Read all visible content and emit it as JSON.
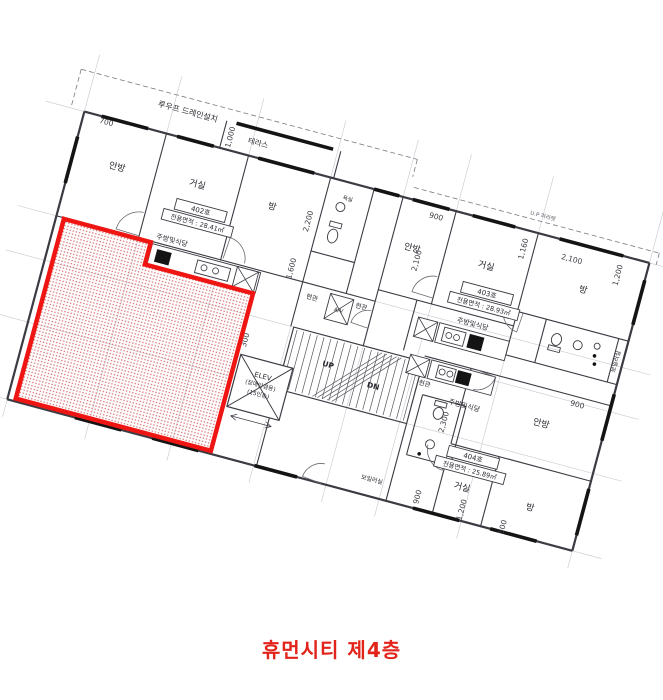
{
  "caption": "휴먼시티 제4층",
  "colors": {
    "caption": "#e2231a",
    "red_outline": "#ee1512",
    "red_dot": "#df7f7f",
    "wall": "#3b3b43",
    "guide": "#c7c7cf",
    "dash": "#7a7a82",
    "text": "#26262e",
    "dim": "#3a3a42",
    "black_fixture": "#141414"
  },
  "plan": {
    "pivot": [
      88,
      98
    ],
    "rotation": 15,
    "guides": [
      [
        0,
        -45,
        0,
        330
      ],
      [
        85,
        -45,
        85,
        330
      ],
      [
        170,
        -45,
        170,
        330
      ],
      [
        255,
        -45,
        255,
        330
      ],
      [
        330,
        -45,
        330,
        330
      ],
      [
        385,
        -45,
        385,
        330
      ],
      [
        470,
        -45,
        470,
        330
      ],
      [
        585,
        -45,
        585,
        330
      ],
      [
        -40,
        14,
        615,
        14
      ],
      [
        -40,
        122,
        615,
        122
      ],
      [
        -40,
        168,
        615,
        168
      ],
      [
        -40,
        232,
        615,
        232
      ],
      [
        -40,
        312,
        615,
        312
      ]
    ],
    "dashed": [
      [
        -14,
        -26,
        334,
        -26
      ],
      [
        -14,
        -26,
        -14,
        12
      ],
      [
        334,
        -26,
        334,
        -8
      ],
      [
        338,
        2,
        592,
        2
      ],
      [
        592,
        2,
        592,
        14
      ]
    ],
    "outer": [
      [
        0,
        14,
        585,
        14
      ],
      [
        585,
        14,
        585,
        312
      ],
      [
        585,
        312,
        0,
        312
      ],
      [
        0,
        312,
        0,
        14
      ]
    ],
    "walls": [
      [
        140,
        -14,
        140,
        14
      ],
      [
        258,
        -14,
        258,
        14
      ],
      [
        85,
        14,
        85,
        122
      ],
      [
        170,
        14,
        170,
        122
      ],
      [
        0,
        122,
        255,
        122
      ],
      [
        255,
        14,
        255,
        168
      ],
      [
        300,
        14,
        300,
        122
      ],
      [
        255,
        90,
        300,
        90
      ],
      [
        255,
        122,
        330,
        122
      ],
      [
        330,
        14,
        330,
        168
      ],
      [
        385,
        14,
        385,
        110
      ],
      [
        330,
        110,
        470,
        110
      ],
      [
        470,
        14,
        470,
        140
      ],
      [
        470,
        95,
        585,
        95
      ],
      [
        500,
        95,
        500,
        140
      ],
      [
        470,
        140,
        585,
        140
      ],
      [
        575,
        95,
        575,
        140
      ],
      [
        370,
        110,
        370,
        162
      ],
      [
        392,
        162,
        585,
        162
      ],
      [
        440,
        162,
        440,
        240
      ],
      [
        440,
        240,
        585,
        240
      ],
      [
        490,
        240,
        490,
        312
      ],
      [
        400,
        200,
        445,
        200
      ],
      [
        445,
        200,
        445,
        262
      ],
      [
        400,
        262,
        445,
        262
      ],
      [
        400,
        200,
        400,
        262
      ],
      [
        440,
        262,
        440,
        312
      ],
      [
        258,
        232,
        258,
        312
      ],
      [
        392,
        232,
        392,
        312
      ]
    ],
    "windows": [
      [
        18,
        14,
        66,
        14
      ],
      [
        96,
        14,
        134,
        14
      ],
      [
        180,
        14,
        238,
        14
      ],
      [
        300,
        14,
        326,
        14
      ],
      [
        340,
        14,
        378,
        14
      ],
      [
        402,
        14,
        446,
        14
      ],
      [
        492,
        14,
        558,
        14
      ],
      [
        585,
        32,
        585,
        78
      ],
      [
        585,
        150,
        585,
        198
      ],
      [
        585,
        248,
        585,
        296
      ],
      [
        70,
        312,
        118,
        312
      ],
      [
        150,
        312,
        198,
        312
      ],
      [
        256,
        312,
        300,
        312
      ],
      [
        420,
        312,
        468,
        312
      ],
      [
        500,
        312,
        548,
        312
      ],
      [
        0,
        40,
        0,
        88
      ],
      [
        150,
        -14,
        250,
        -14
      ]
    ],
    "thin": [
      [
        220,
        270,
        262,
        270
      ],
      [
        220,
        270,
        226,
        267
      ],
      [
        220,
        270,
        226,
        273
      ],
      [
        262,
        270,
        256,
        267
      ],
      [
        262,
        270,
        256,
        273
      ]
    ],
    "stairs": {
      "box": [
        258,
        168,
        134,
        64
      ],
      "tread_x1": 262,
      "tread_x2": 388,
      "tread_y1": 170,
      "tread_y2": 230,
      "step": 7,
      "diag": [
        [
          294,
          230,
          350,
          170
        ],
        [
          299,
          230,
          355,
          170
        ],
        [
          304,
          230,
          360,
          170
        ],
        [
          309,
          230,
          365,
          170
        ],
        [
          314,
          230,
          370,
          170
        ]
      ]
    },
    "elevator": {
      "box": [
        214,
        208,
        54,
        54
      ],
      "lines": [
        "ELEV",
        "(장애인겸용)",
        "(15인승)"
      ],
      "cx": 241,
      "ty": 226,
      "lh": 9
    },
    "rects": [
      [
        285,
        126,
        24,
        26
      ],
      [
        100,
        124,
        112,
        21
      ],
      [
        398,
        126,
        72,
        20
      ],
      [
        400,
        164,
        66,
        19
      ],
      [
        188,
        124,
        22,
        21
      ],
      [
        376,
        126,
        20,
        20
      ],
      [
        378,
        164,
        20,
        19
      ],
      [
        148,
        128,
        34,
        13
      ],
      [
        404,
        129,
        22,
        14
      ],
      [
        408,
        167,
        18,
        13
      ]
    ],
    "crosses": [
      [
        214,
        208,
        54,
        54
      ],
      [
        285,
        126,
        24,
        26
      ],
      [
        188,
        124,
        22,
        21
      ],
      [
        376,
        126,
        20,
        20
      ],
      [
        378,
        164,
        20,
        19
      ]
    ],
    "black_rects": [
      [
        106,
        128,
        15,
        13
      ],
      [
        430,
        129,
        15,
        14
      ],
      [
        428,
        167,
        14,
        13
      ]
    ],
    "burners": [
      [
        156,
        134,
        3
      ],
      [
        168,
        134,
        3
      ],
      [
        410,
        136,
        3
      ],
      [
        418,
        136,
        3
      ],
      [
        413,
        173,
        3
      ],
      [
        421,
        173,
        3
      ]
    ],
    "fixtures": {
      "ellipses": [
        [
          272,
          70,
          5,
          7
        ],
        [
          515,
          112,
          5,
          6
        ],
        [
          420,
          214,
          5,
          6
        ]
      ],
      "tanks": [
        [
          266,
          56,
          12,
          5
        ],
        [
          509,
          119,
          12,
          5
        ],
        [
          414,
          202,
          12,
          5
        ]
      ],
      "sinks": [
        [
          272,
          40,
          4.5
        ],
        [
          537,
          112,
          4.5
        ],
        [
          420,
          246,
          4.5
        ],
        [
          556,
          108,
          3
        ]
      ],
      "dots": [
        [
          556,
          118,
          1.8
        ],
        [
          558,
          126,
          1.8
        ],
        [
          412,
          258,
          1.8
        ]
      ]
    },
    "doors": [
      {
        "c": [
          85,
          120
        ],
        "r": 24,
        "a1": 182,
        "a2": 266
      },
      {
        "c": [
          172,
          120
        ],
        "r": 22,
        "a1": 274,
        "a2": 358
      },
      {
        "c": [
          385,
          104
        ],
        "r": 22,
        "a1": 182,
        "a2": 266
      },
      {
        "c": [
          476,
          95
        ],
        "r": 20,
        "a1": 94,
        "a2": 176
      },
      {
        "c": [
          440,
          246
        ],
        "r": 22,
        "a1": 94,
        "a2": 178
      },
      {
        "c": [
          446,
          162
        ],
        "r": 20,
        "a1": 6,
        "a2": 86
      },
      {
        "c": [
          330,
          150
        ],
        "r": 18,
        "a1": 184,
        "a2": 266
      },
      {
        "c": [
          325,
          312
        ],
        "r": 20,
        "a1": 186,
        "a2": 266
      }
    ],
    "unit_boxes": [
      {
        "x": 112,
        "y": 74,
        "w": 52,
        "h": 11,
        "t": "402호",
        "s": 7
      },
      {
        "x": 102,
        "y": 87,
        "w": 72,
        "h": 11,
        "t": "전용면적 : 28.41㎡",
        "s": 6.5
      },
      {
        "x": 410,
        "y": 80,
        "w": 52,
        "h": 11,
        "t": "403호",
        "s": 7
      },
      {
        "x": 400,
        "y": 93,
        "w": 72,
        "h": 11,
        "t": "전용면적 : 28.93㎡",
        "s": 6.5
      },
      {
        "x": 439,
        "y": 242,
        "w": 52,
        "h": 11,
        "t": "404호",
        "s": 7
      },
      {
        "x": 429,
        "y": 255,
        "w": 72,
        "h": 11,
        "t": "전용면적 : 25.89㎡",
        "s": 6.5
      }
    ],
    "texts": [
      {
        "t": "루우프 드레인설치",
        "x": 100,
        "y": -10,
        "s": 8
      },
      {
        "t": "테라스",
        "x": 176,
        "y": 2,
        "s": 7.5
      },
      {
        "t": "U.P 파라펫",
        "x": 470,
        "y": -2,
        "s": 5.5,
        "c": "#666670"
      },
      {
        "t": "안방",
        "x": 46,
        "y": 62,
        "s": 9
      },
      {
        "t": "거실",
        "x": 128,
        "y": 58,
        "s": 9
      },
      {
        "t": "방",
        "x": 206,
        "y": 60,
        "s": 9
      },
      {
        "t": "주방및식당",
        "x": 118,
        "y": 118,
        "s": 7
      },
      {
        "t": "욕실",
        "x": 277,
        "y": 32,
        "s": 5.5
      },
      {
        "t": "현관",
        "x": 268,
        "y": 137,
        "s": 6.5
      },
      {
        "t": "현관",
        "x": 318,
        "y": 133,
        "s": 6.5
      },
      {
        "t": "A/V",
        "x": 297,
        "y": 142,
        "s": 5.5
      },
      {
        "t": "안방",
        "x": 352,
        "y": 64,
        "s": 9
      },
      {
        "t": "거실",
        "x": 428,
        "y": 62,
        "s": 9
      },
      {
        "t": "방",
        "x": 528,
        "y": 60,
        "s": 9
      },
      {
        "t": "주방및식당",
        "x": 430,
        "y": 121,
        "s": 7
      },
      {
        "t": "보일러실",
        "x": 580,
        "y": 118,
        "s": 6,
        "v": 1
      },
      {
        "t": "현관",
        "x": 399,
        "y": 191,
        "s": 6.5
      },
      {
        "t": "주방및식당",
        "x": 443,
        "y": 202,
        "s": 7
      },
      {
        "t": "안방",
        "x": 522,
        "y": 200,
        "s": 9
      },
      {
        "t": "거실",
        "x": 462,
        "y": 282,
        "s": 9
      },
      {
        "t": "방",
        "x": 533,
        "y": 284,
        "s": 9
      },
      {
        "t": "보일러실",
        "x": 373,
        "y": 297,
        "s": 6
      },
      {
        "t": "UP",
        "x": 301,
        "y": 198,
        "s": 7.5,
        "b": 1
      },
      {
        "t": "DN",
        "x": 350,
        "y": 207,
        "s": 7.5,
        "b": 1
      },
      {
        "t": "700",
        "x": 24,
        "y": 21,
        "s": 7.5,
        "d": 1
      },
      {
        "t": "1,000",
        "x": 150,
        "y": 1,
        "s": 7.5,
        "v": 1,
        "d": 1
      },
      {
        "t": "2,200",
        "x": 247,
        "y": 62,
        "s": 7.5,
        "v": 1,
        "d": 1
      },
      {
        "t": "1,600",
        "x": 243,
        "y": 112,
        "s": 7.5,
        "v": 1,
        "d": 1
      },
      {
        "t": "300",
        "x": 217,
        "y": 193,
        "s": 7.5,
        "v": 1,
        "d": 1
      },
      {
        "t": "900",
        "x": 367,
        "y": 27,
        "s": 7.5,
        "d": 1
      },
      {
        "t": "2,100",
        "x": 362,
        "y": 72,
        "s": 7.5,
        "v": 1,
        "d": 1
      },
      {
        "t": "1,160",
        "x": 462,
        "y": 33,
        "s": 7.5,
        "v": 1,
        "d": 1
      },
      {
        "t": "2,100",
        "x": 509,
        "y": 33,
        "s": 7.5,
        "d": 1
      },
      {
        "t": "1,200",
        "x": 560,
        "y": 34,
        "s": 7.5,
        "v": 1,
        "d": 1
      },
      {
        "t": "900",
        "x": 552,
        "y": 172,
        "s": 7.5,
        "d": 1
      },
      {
        "t": "2,300",
        "x": 430,
        "y": 221,
        "s": 7.5,
        "v": 1,
        "d": 1
      },
      {
        "t": "900",
        "x": 424,
        "y": 300,
        "s": 7.5,
        "v": 1,
        "d": 1
      },
      {
        "t": "1,200",
        "x": 470,
        "y": 301,
        "s": 7.5,
        "v": 1,
        "d": 1
      },
      {
        "t": "500",
        "x": 514,
        "y": 307,
        "s": 7.5,
        "v": 1,
        "d": 1
      }
    ],
    "red_overlay": {
      "points": "8,123 98,123 98,146 210,146 210,309 8,309",
      "stroke_width": 4.5
    }
  }
}
